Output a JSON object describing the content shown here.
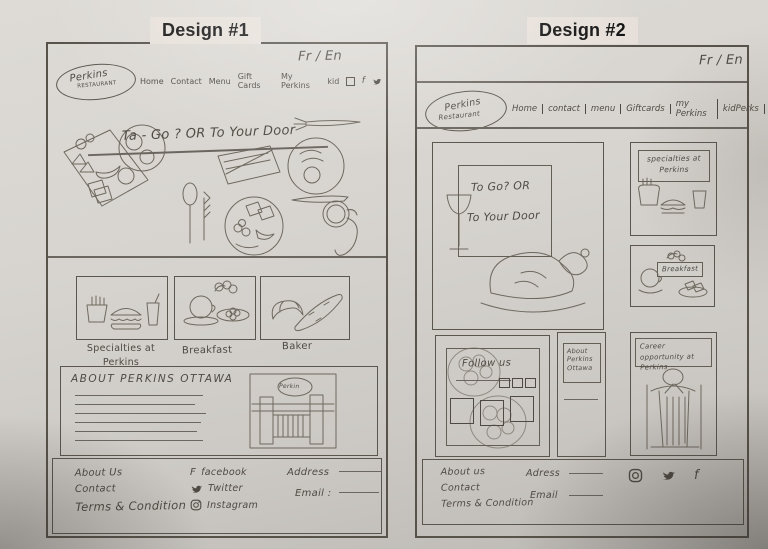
{
  "page": {
    "design1_title": "Design #1",
    "design2_title": "Design #2"
  },
  "design1": {
    "lang_toggle": "Fr / En",
    "logo_name": "Perkins",
    "logo_subtitle": "RESTAURANT",
    "nav_items": [
      "Home",
      "Contact",
      "Menu",
      "Gift Cards",
      "My Perkins",
      "kid"
    ],
    "nav_facebook_glyph": "f",
    "hero_headline": "Ta - Go ?  OR  To Your Door",
    "cards": [
      {
        "label": "Specialties at Perkins"
      },
      {
        "label": "Breakfast"
      },
      {
        "label": "Baker"
      }
    ],
    "about_title": "ABOUT PERKINS OTTAWA",
    "storefront_sign": "Perkin",
    "footer": {
      "links": [
        "About Us",
        "Contact",
        "Terms & Condition"
      ],
      "facebook_glyph": "F",
      "facebook_label": "facebook",
      "twitter_label": "Twitter",
      "instagram_label": "Instagram",
      "address_label": "Address",
      "email_label": "Email :"
    }
  },
  "design2": {
    "lang_toggle": "Fr / En",
    "logo_name": "Perkins",
    "logo_subtitle": "Restaurant",
    "nav_items": [
      "Home",
      "contact",
      "menu",
      "Giftcards",
      "my Perkins",
      "kidPerks"
    ],
    "nav_facebook_glyph": "f",
    "hero_line1": "To Go? OR",
    "hero_line2": "To Your Door",
    "specialties_label": "specialties at Perkins",
    "breakfast_label": "Breakfast",
    "follow_label": "Follow us",
    "about_tile_label": "About Perkins Ottawa",
    "career_label": "Career opportunity at Perkins",
    "footer": {
      "links": [
        "About us",
        "Contact",
        "Terms & Condition"
      ],
      "address_label": "Adress",
      "email_label": "Email",
      "facebook_glyph": "f"
    }
  },
  "colors": {
    "ink": "#4e4a43",
    "frame": "#57524a",
    "paper": "#d6d3ce"
  }
}
